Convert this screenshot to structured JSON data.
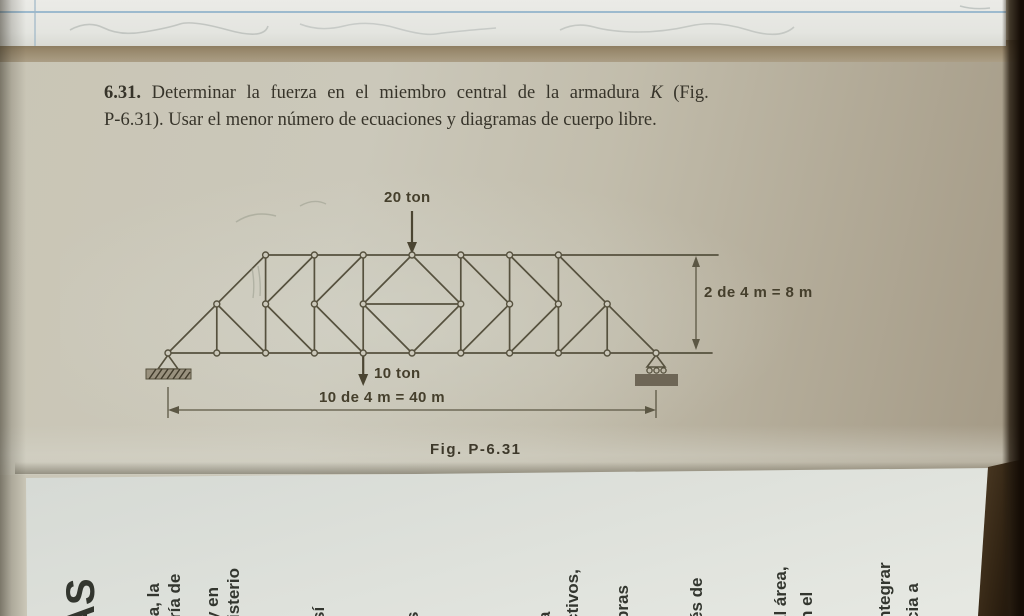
{
  "problem": {
    "number": "6.31.",
    "statement_line1": "Determinar la fuerza en el miembro central de la armadura",
    "member_symbol": "K",
    "statement_line1_end": "(Fig.",
    "statement_line2": "P-6.31). Usar el menor número de ecuaciones y diagramas de cuerpo libre."
  },
  "figure": {
    "caption": "Fig. P-6.31",
    "top_load_label": "20 ton",
    "bottom_load_label": "10 ton",
    "span_dimension_label": "10 de 4 m = 40 m",
    "height_dimension_label": "2 de 4 m = 8 m"
  },
  "sheet": {
    "fragments": [
      "AS",
      "ia, la",
      "ría de",
      "y en",
      "isterio",
      "sí",
      "s",
      "a",
      "ctivos,",
      "bras",
      "és de",
      "al área,",
      "n el",
      "ntegrar",
      "cia a"
    ]
  },
  "colors": {
    "page": "#c9c5b5",
    "ink": "#56513e",
    "label_ink": "#453f2c",
    "sheet_paper": "#dde0da",
    "ruled_line_blue": "#8fb2ca",
    "page_edge_dark": "#140c05"
  }
}
